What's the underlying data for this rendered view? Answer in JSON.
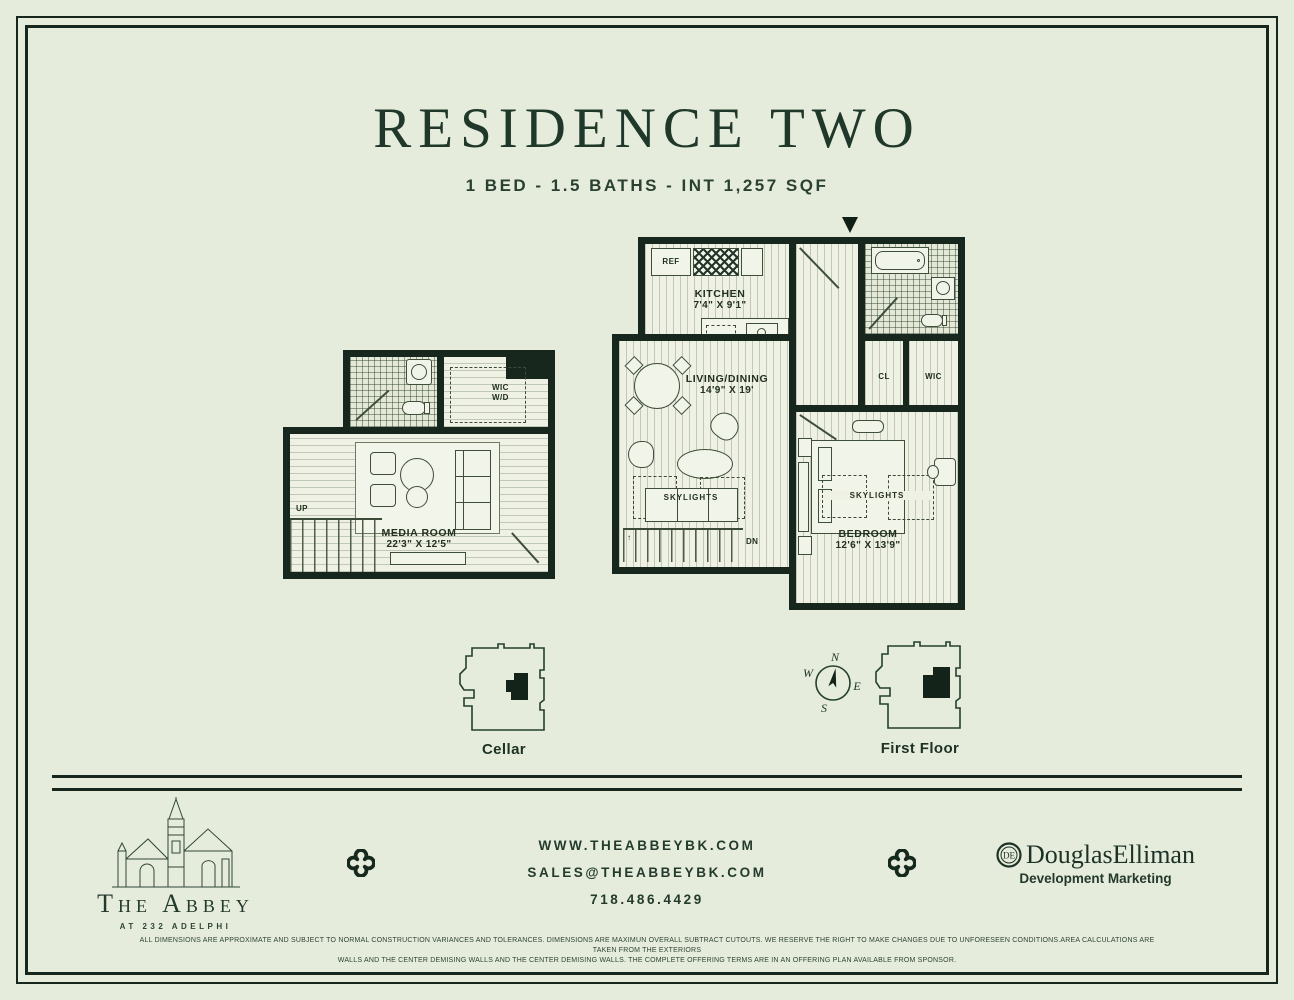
{
  "page": {
    "title": "RESIDENCE TWO",
    "subtitle": "1 BED - 1.5 BATHS - INT 1,257 SQF"
  },
  "colors": {
    "background": "#e6ecdc",
    "ink": "#20382a",
    "wall": "#17271d"
  },
  "floorplans": {
    "first_floor": {
      "kitchen_name": "KITCHEN",
      "kitchen_dims": "7'4\" X 9'1\"",
      "living_name": "LIVING/DINING",
      "living_dims": "14'9\" X 19'",
      "bedroom_name": "BEDROOM",
      "bedroom_dims": "12'6\" X 13'9\"",
      "ref": "REF",
      "dw": "DW",
      "cl": "CL",
      "wic": "WIC",
      "skylights_living": "SKYLIGHTS",
      "skylights_bedroom": "SKYLIGHTS",
      "dn": "DN"
    },
    "cellar": {
      "media_name": "MEDIA ROOM",
      "media_dims": "22'3\" X 12'5\"",
      "wic_line1": "WIC",
      "wic_line2": "W/D",
      "up": "UP"
    }
  },
  "key_plans": {
    "cellar_label": "Cellar",
    "first_floor_label": "First Floor",
    "compass": {
      "n": "N",
      "e": "E",
      "s": "S",
      "w": "W"
    }
  },
  "footer": {
    "abbey_name": "The Abbey",
    "abbey_tagline": "AT 232 ADELPHI",
    "website": "WWW.THEABBEYBK.COM",
    "email": "SALES@THEABBEYBK.COM",
    "phone": "718.486.4429",
    "de_monogram": "DE",
    "de_name": "DouglasElliman",
    "de_division": "Development Marketing",
    "disclaimer_line1": "ALL DIMENSIONS ARE APPROXIMATE AND SUBJECT TO NORMAL CONSTRUCTION VARIANCES AND TOLERANCES. DIMENSIONS ARE MAXIMUN OVERALL SUBTRACT CUTOUTS. WE RESERVE THE RIGHT TO MAKE CHANGES DUE TO UNFORESEEN CONDITIONS.AREA CALCULATIONS ARE TAKEN FROM THE EXTERIORS",
    "disclaimer_line2": "WALLS AND THE CENTER DEMISING WALLS AND THE CENTER DEMISING WALLS. THE COMPLETE OFFERING TERMS ARE IN AN OFFERING PLAN AVAILABLE FROM SPONSOR."
  }
}
